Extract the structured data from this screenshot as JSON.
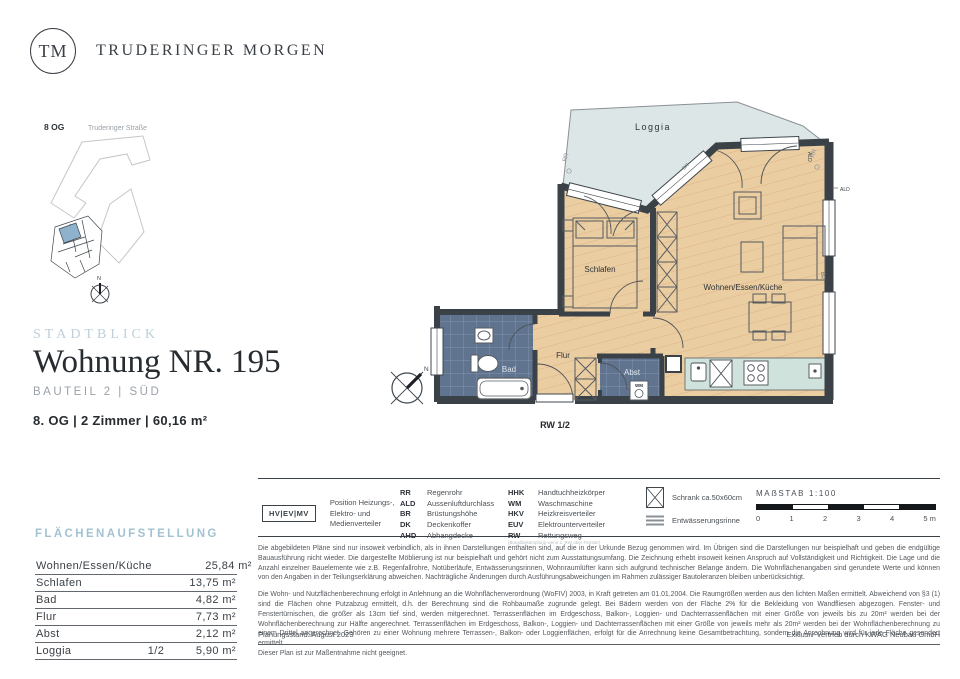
{
  "brand": {
    "initials": "TM",
    "name": "TRUDERINGER MORGEN"
  },
  "site_map": {
    "floor": "8 OG",
    "street": "Truderinger Straße",
    "north": "N"
  },
  "title_block": {
    "project": "STADTBLICK",
    "title": "Wohnung NR. 195",
    "subtitle": "BAUTEIL 2 | SÜD",
    "details": "8. OG | 2 Zimmer | 60,16 m²"
  },
  "floor_plan": {
    "rooms": {
      "loggia": "Loggia",
      "schlafen": "Schlafen",
      "wohnen": "Wohnen/Essen/Küche",
      "flur": "Flur",
      "bad": "Bad",
      "abst": "Abst"
    },
    "annotations": {
      "rw": "RW 1/2",
      "rr": "RR",
      "ald": "ALD",
      "br": "BR",
      "wm": "WM",
      "north": "N"
    }
  },
  "area_table": {
    "heading": "FLÄCHENAUFSTELLUNG",
    "rows": [
      {
        "label": "Wohnen/Essen/Küche",
        "factor": "",
        "value": "25,84 m²"
      },
      {
        "label": "Schlafen",
        "factor": "",
        "value": "13,75 m²"
      },
      {
        "label": "Bad",
        "factor": "",
        "value": "4,82 m²"
      },
      {
        "label": "Flur",
        "factor": "",
        "value": "7,73 m²"
      },
      {
        "label": "Abst",
        "factor": "",
        "value": "2,12 m²"
      },
      {
        "label": "Loggia",
        "factor": "1/2",
        "value": "5,90 m²"
      }
    ]
  },
  "legend": {
    "hv_box": "HV|EV|MV",
    "hv_text": "Position Heizungs-, Elektro- und Medienverteiler",
    "col1": [
      {
        "abbr": "RR",
        "label": "Regenrohr"
      },
      {
        "abbr": "ALD",
        "label": "Aussenluftdurchlass"
      },
      {
        "abbr": "BR",
        "label": "Brüstungshöhe"
      },
      {
        "abbr": "DK",
        "label": "Deckenkoffer"
      },
      {
        "abbr": "AHD",
        "label": "Abhangdecke"
      }
    ],
    "col2": [
      {
        "abbr": "HHK",
        "label": "Handtuchheizkörper"
      },
      {
        "abbr": "WM",
        "label": "Waschmaschine"
      },
      {
        "abbr": "HKV",
        "label": "Heizkreisverteiler"
      },
      {
        "abbr": "EUV",
        "label": "Elektrounterverteiler"
      },
      {
        "abbr": "RW",
        "label": "Rettungsweg"
      }
    ],
    "rw_note": "(Brandbekämpfung wenn 2. RW über Fenster)",
    "icons": [
      {
        "label": "Schrank ca.50x60cm"
      },
      {
        "label": "Entwässerungsrinne"
      }
    ]
  },
  "scale": {
    "label": "MAẞSTAB 1:100",
    "ticks": [
      "0",
      "1",
      "2",
      "3",
      "4",
      "5 m"
    ]
  },
  "disclaimer": {
    "p1": "Die abgebildeten Pläne sind nur insoweit verbindlich, als in ihnen Darstellungen enthalten sind, auf die in der Urkunde Bezug genommen wird. Im Übrigen sind die Darstellungen nur beispielhaft und geben die endgültige Bauausführung nicht wieder. Die dargestellte Möblierung ist nur beispielhaft und gehört nicht zum Ausstattungsumfang. Die Zeichnung erhebt insoweit keinen Anspruch auf Vollständigkeit und Richtigkeit. Die Lage und die Anzahl einzelner Bauelemente wie z.B. Regenfallrohre, Notüberläufe, Entwässerungsrinnen, Wohnraumlüfter kann sich aufgrund technischer Belange ändern. Die Wohnflächenangaben sind gerundete Werte und können von den Angaben in der Teilungserklärung abweichen. Nachträgliche Änderungen durch Ausführungsabweichungen im Rahmen zulässiger Bautoleranzen bleiben unberücksichtigt.",
    "p2": "Die Wohn- und Nutzflächenberechnung erfolgt in Anlehnung an die Wohnflächenverordnung (WoFIV) 2003, in Kraft getreten am 01.01.2004. Die Raumgrößen werden aus den lichten Maßen ermittelt. Abweichend von §3 (1) sind die Flächen ohne Putzabzug ermittelt, d.h. der Berechnung sind die Rohbaumaße zugrunde gelegt. Bei Bädern werden von der Fläche 2% für die Bekleidung von Wandfliesen abgezogen. Fenster- und Fenstertürnischen, die größer als 13cm tief sind, werden mitgerechnet. Terrassenflächen im Erdgeschoss, Balkon-, Loggien- und Dachterrassenflächen mit einer Größe von jeweils bis zu 20m² werden bei der Wohnflächenberechnung zur Hälfte angerechnet. Terrassenflächen im Erdgeschoss, Balkon-, Loggien- und Dachterrassenflächen mit einer Größe von jeweils mehr als 20m² werden bei der Wohnflächenberechnung zu einem Drittel angerechnet. Gehören zu einer Wohnung mehrere Terrassen-, Balkon- oder Loggienflächen, erfolgt für die Anrechnung keine Gesamtbetrachtung, sondern die Anrechnung wird für jede Fläche gesondert ermittelt.",
    "p3": "Dieser Plan ist zur Maßentnahme nicht geeignet."
  },
  "footer": {
    "left": "Planungsstand: August 2023",
    "right": "Exklusiv-Vertrieb durch KWAG Neubau GmbH"
  },
  "colors": {
    "wall": "#3a4147",
    "wood": "#ebcda2",
    "tile": "#60748f",
    "loggia": "#dde6e6",
    "counter": "#cfe3dc",
    "accent_light_blue": "#a2c2d2"
  }
}
